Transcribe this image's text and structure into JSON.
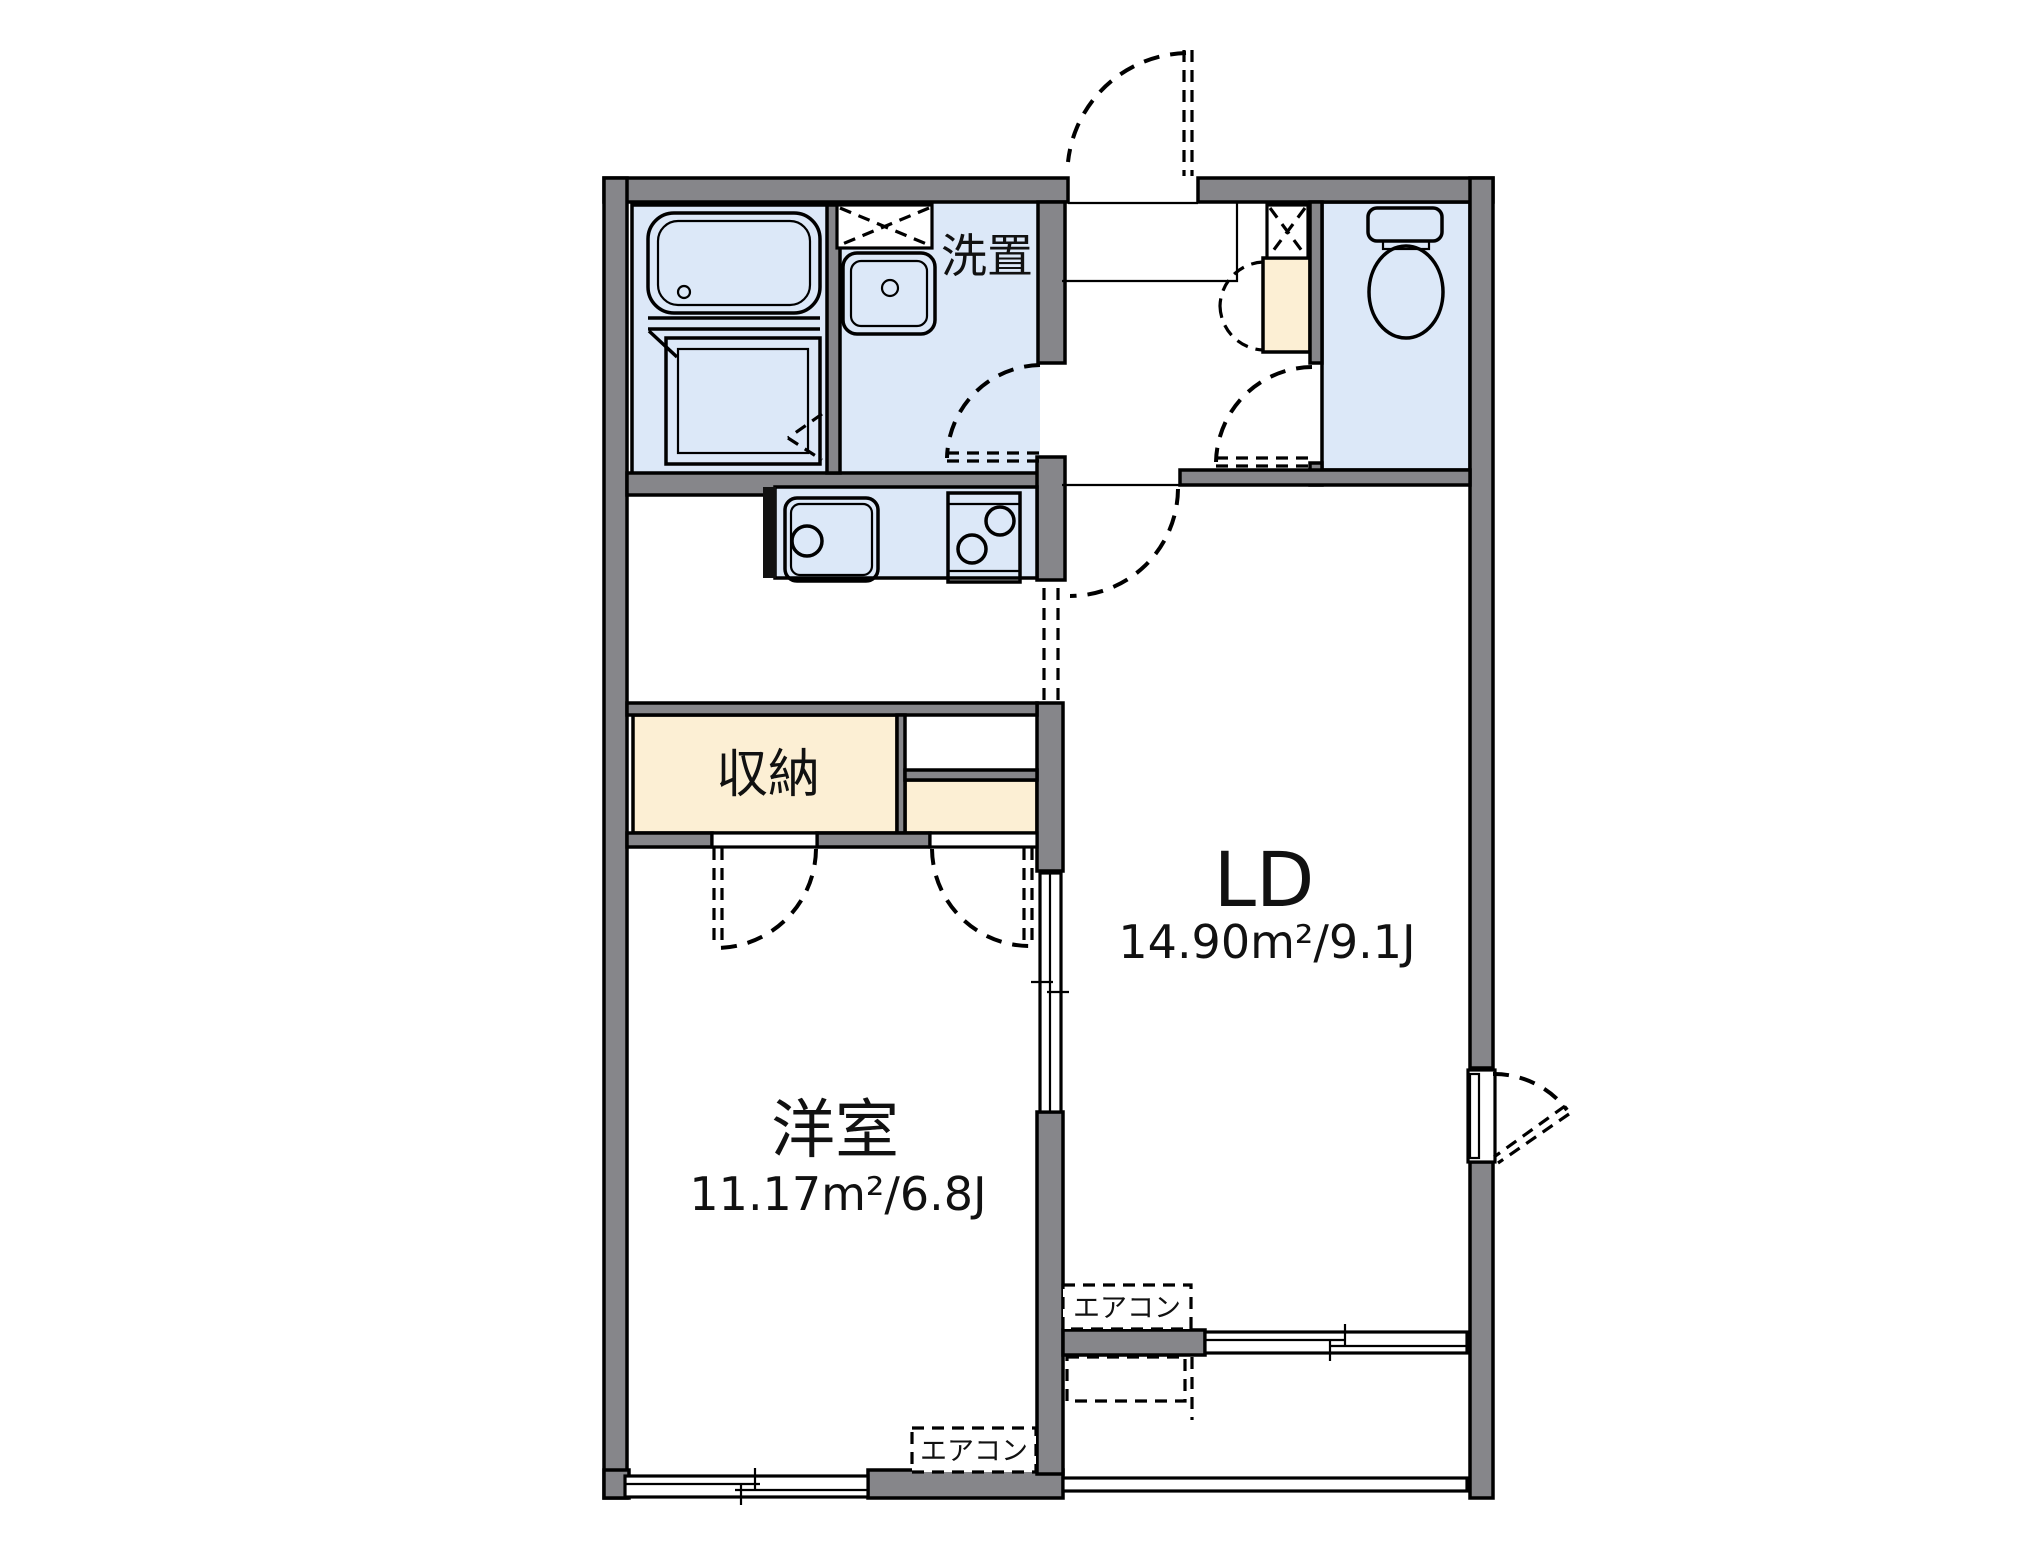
{
  "plan": {
    "rooms": {
      "ld": {
        "label": "LD",
        "area": "14.90m²/9.1J"
      },
      "western": {
        "label": "洋室",
        "area": "11.17m²/6.8J"
      },
      "closet": {
        "label": "収納"
      },
      "laundry": {
        "label": "洗置"
      }
    },
    "equipment": {
      "aircon": "エアコン"
    },
    "colors": {
      "wall": "#86868a",
      "wet_area": "#dce8f8",
      "closet_fill": "#fcefd4",
      "line": "#000000"
    }
  }
}
